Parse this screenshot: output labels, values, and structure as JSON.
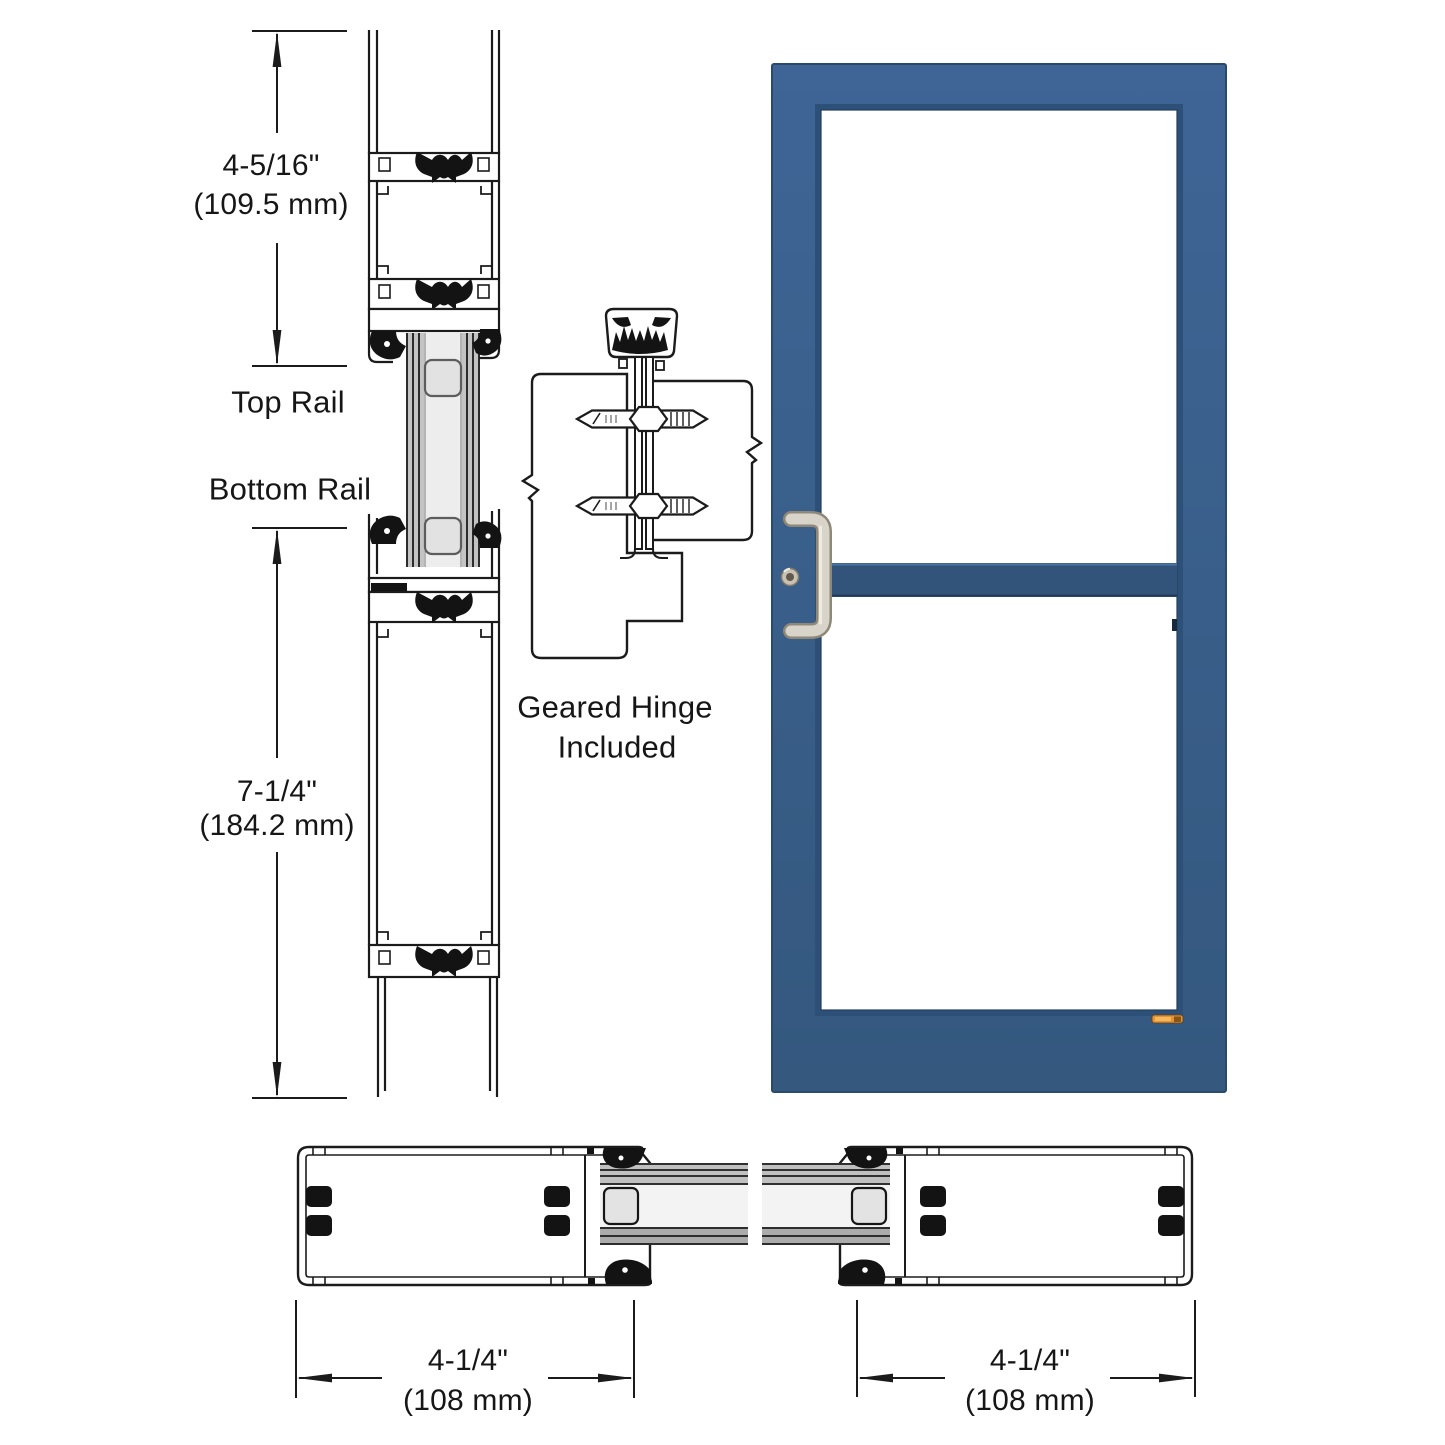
{
  "diagram": {
    "line_color": "#1b1b1b",
    "labels": {
      "top_rail": "Top Rail",
      "bottom_rail": "Bottom Rail",
      "geared_hinge_line1": "Geared Hinge",
      "geared_hinge_line2": "Included"
    },
    "dimensions": {
      "top_rail_height": {
        "inches": "4-5/16\"",
        "mm": "(109.5 mm)"
      },
      "bottom_rail_height": {
        "inches": "7-1/4\"",
        "mm": "(184.2 mm)"
      },
      "left_stile_width": {
        "inches": "4-1/4\"",
        "mm": "(108 mm)"
      },
      "right_stile_width": {
        "inches": "4-1/4\"",
        "mm": "(108 mm)"
      }
    }
  },
  "door": {
    "frame_color_top": "#3e6596",
    "frame_color_bottom": "#34587e",
    "mid_rail_color": "#32547a",
    "glass_color": "#ffffff",
    "handle_color": "#d9d4c9",
    "brand_label_color": "#e29336"
  }
}
